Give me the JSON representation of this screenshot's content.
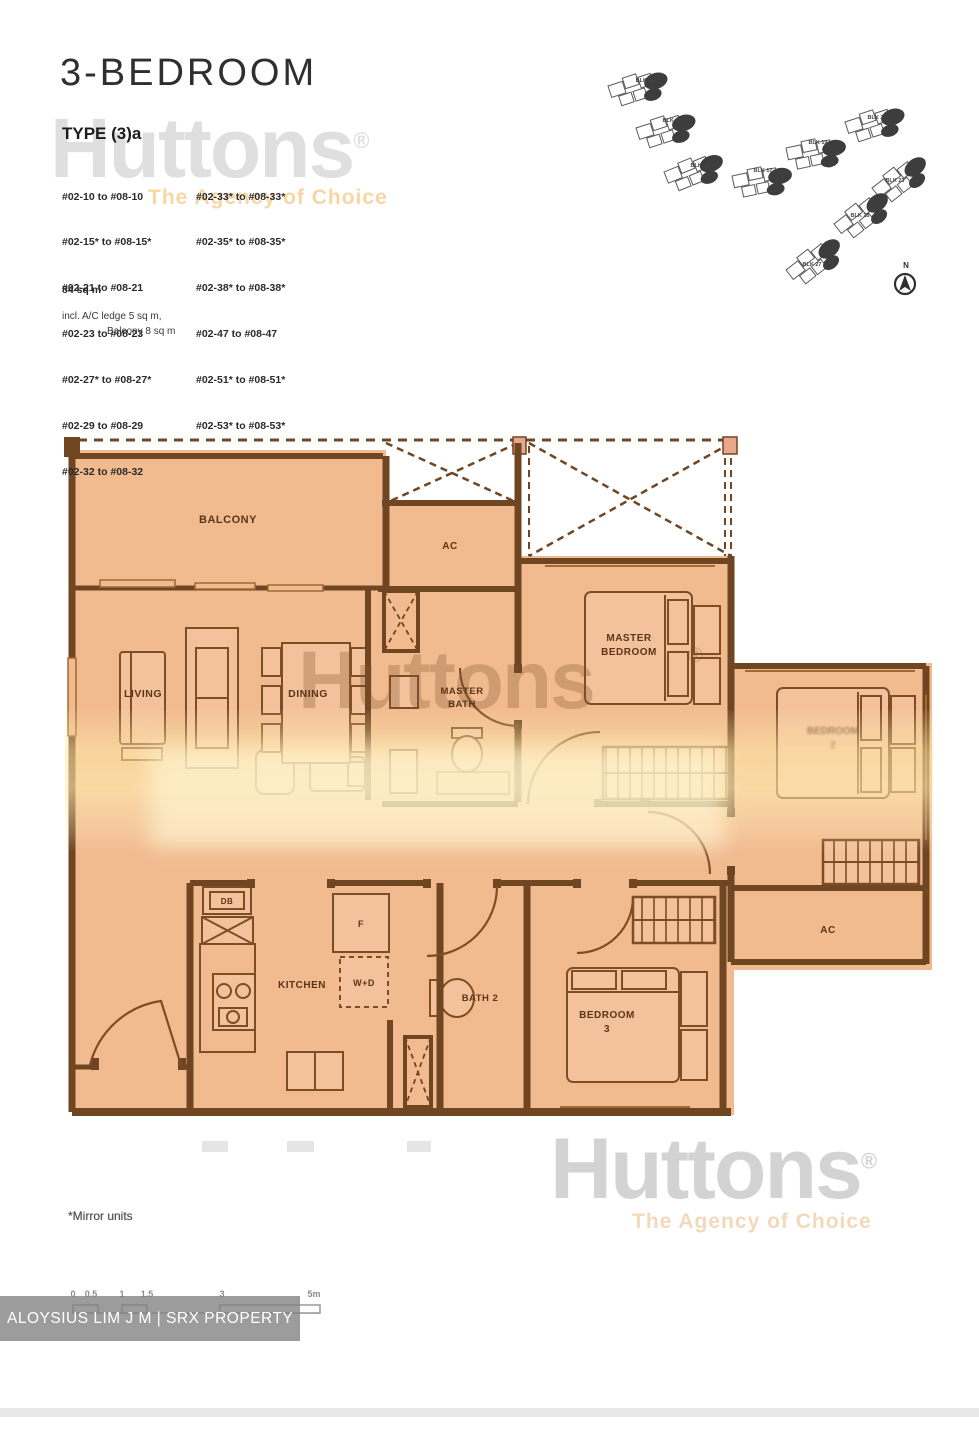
{
  "header": {
    "title": "3-BEDROOM",
    "type_label": "TYPE (3)a"
  },
  "units": {
    "col1": [
      "#02-10 to #08-10",
      "#02-15* to #08-15*",
      "#02-21 to #08-21",
      "#02-23 to #08-23",
      "#02-27* to #08-27*",
      "#02-29 to #08-29",
      "#02-32 to #08-32"
    ],
    "col2": [
      "#02-33* to #08-33*",
      "#02-35* to #08-35*",
      "#02-38* to #08-38*",
      "#02-47 to #08-47",
      "#02-51* to #08-51*",
      "#02-53* to #08-53*"
    ]
  },
  "area": {
    "size": "84 sq m",
    "note_line1": "incl. A/C ledge 5 sq m,",
    "note_line2": "Balcony 8 sq m"
  },
  "watermark": {
    "brand": "Huttons",
    "registered": "®",
    "tagline": "The Agency of Choice"
  },
  "site_plan": {
    "north_label": "N",
    "blocks": [
      {
        "label": "BLK 11"
      },
      {
        "label": "BLK 15"
      },
      {
        "label": "BLK 13"
      },
      {
        "label": "BLK 17"
      },
      {
        "label": "BLK 19"
      },
      {
        "label": "BLK 21"
      },
      {
        "label": "BLK 23"
      },
      {
        "label": "BLK 25"
      },
      {
        "label": "BLK 27"
      }
    ]
  },
  "plan": {
    "labels": {
      "balcony": "BALCONY",
      "ac_upper": "AC",
      "living": "LIVING",
      "dining": "DINING",
      "master_bath_line1": "MASTER",
      "master_bath_line2": "BATH",
      "master_bedroom_line1": "MASTER",
      "master_bedroom_line2": "BEDROOM",
      "bedroom2_line1": "BEDROOM",
      "bedroom2_line2": "2",
      "bedroom3_line1": "BEDROOM",
      "bedroom3_line2": "3",
      "kitchen": "KITCHEN",
      "bath2": "BATH 2",
      "washer_dryer": "W+D",
      "fridge": "F",
      "db": "DB",
      "ac_lower": "AC"
    }
  },
  "scale_bar": {
    "ticks": [
      "0",
      "0.5",
      "1",
      "1.5",
      "3",
      "5m"
    ]
  },
  "footer": {
    "mirror_note": "*Mirror units",
    "agent_banner": "ALOYSIUS LIM J M | SRX PROPERTY"
  },
  "colors": {
    "plan_fill": "#f1ba8f",
    "wall": "#6f4522",
    "furniture_line": "#7d4e26",
    "highlight_band": "#ffe9b0",
    "watermark_gray": "#d2d2d2",
    "watermark_tan_mid": "#82542e",
    "tagline_yellow": "#f3bb66"
  }
}
